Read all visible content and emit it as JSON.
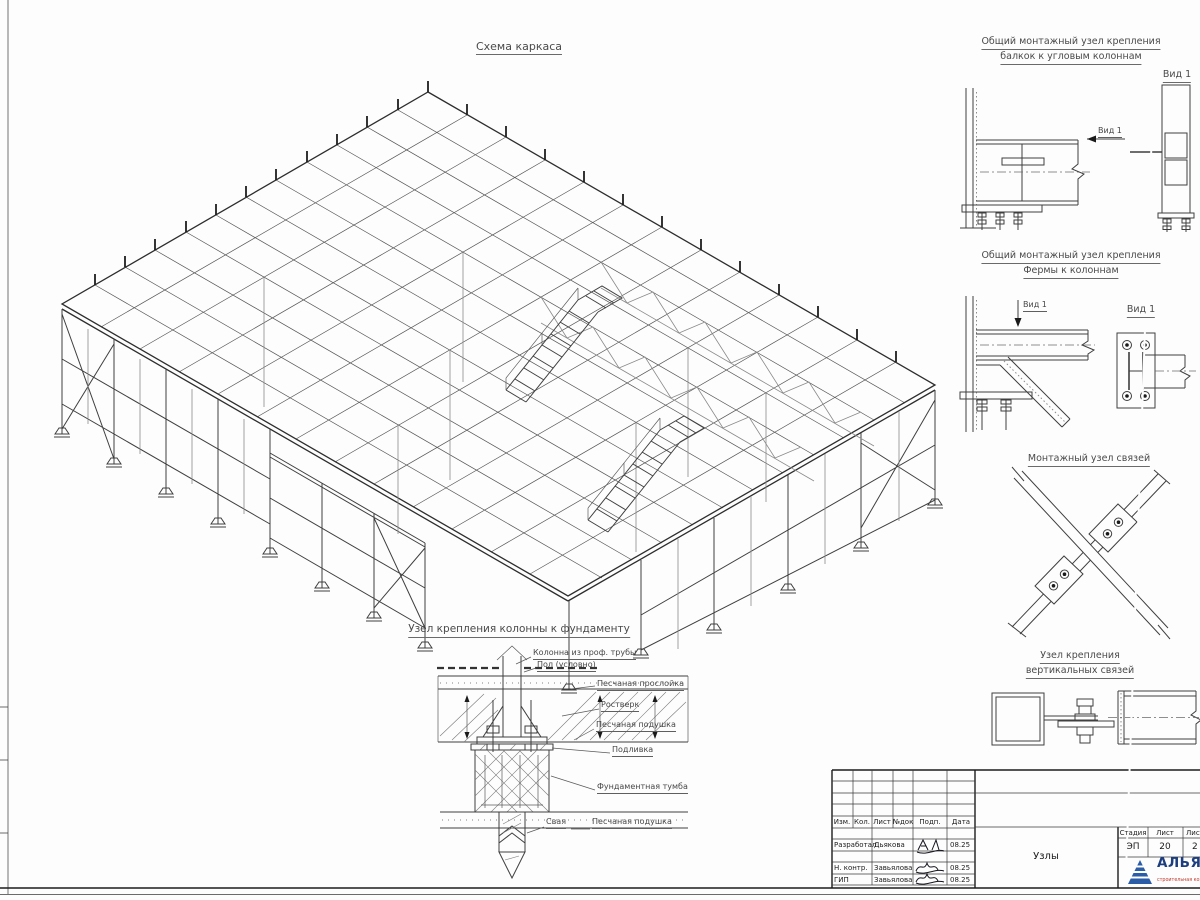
{
  "sheet": {
    "main_title": "Схема каркаса",
    "details": [
      {
        "title1": "Общий монтажный узел крепления",
        "title2": "балкок к угловым колоннам",
        "arrow_label": "Вид 1",
        "view_title": "Вид 1"
      },
      {
        "title1": "Общий монтажный узел крепления",
        "title2": "Фермы к колоннам",
        "arrow_label": "Вид 1",
        "view_title": "Вид 1"
      },
      {
        "title1": "Монтажный узел связей"
      },
      {
        "title1": "Узел крепления",
        "title2": "вертикальных связей"
      }
    ],
    "foundation": {
      "title": "Узел крепления колонны к фундаменту",
      "labels": {
        "column": "Колонна из проф. трубы",
        "floor": "Пол (условно)",
        "sand_layer": "Песчаная прослойка",
        "grillage": "Ростверк",
        "sand_bed": "Песчаная подушка",
        "grout": "Подливка",
        "pedestal": "Фундаментная тумба",
        "pile": "Свая",
        "sand_bed2": "Песчаная подушка"
      }
    },
    "title_block": {
      "rev_headers": [
        "Изм.",
        "Кол.",
        "Лист",
        "№док",
        "Подп.",
        "Дата"
      ],
      "sign_rows": [
        {
          "role": "Разработал",
          "name": "Дьякова",
          "date": "08.25"
        },
        {
          "role": "Н. контр.",
          "name": "Завьялова",
          "date": "08.25"
        },
        {
          "role": "ГИП",
          "name": "Завьялова",
          "date": "08.25"
        }
      ],
      "doc_name": "Узлы",
      "stage_label": "Стадия",
      "stage_value": "ЭП",
      "sheet_label": "Лист",
      "sheet_value": "20",
      "sheets_label": "Листов",
      "sheets_value": "2",
      "logo": {
        "name": "АЛЬЯНС",
        "tagline": "строительная компания"
      }
    }
  }
}
